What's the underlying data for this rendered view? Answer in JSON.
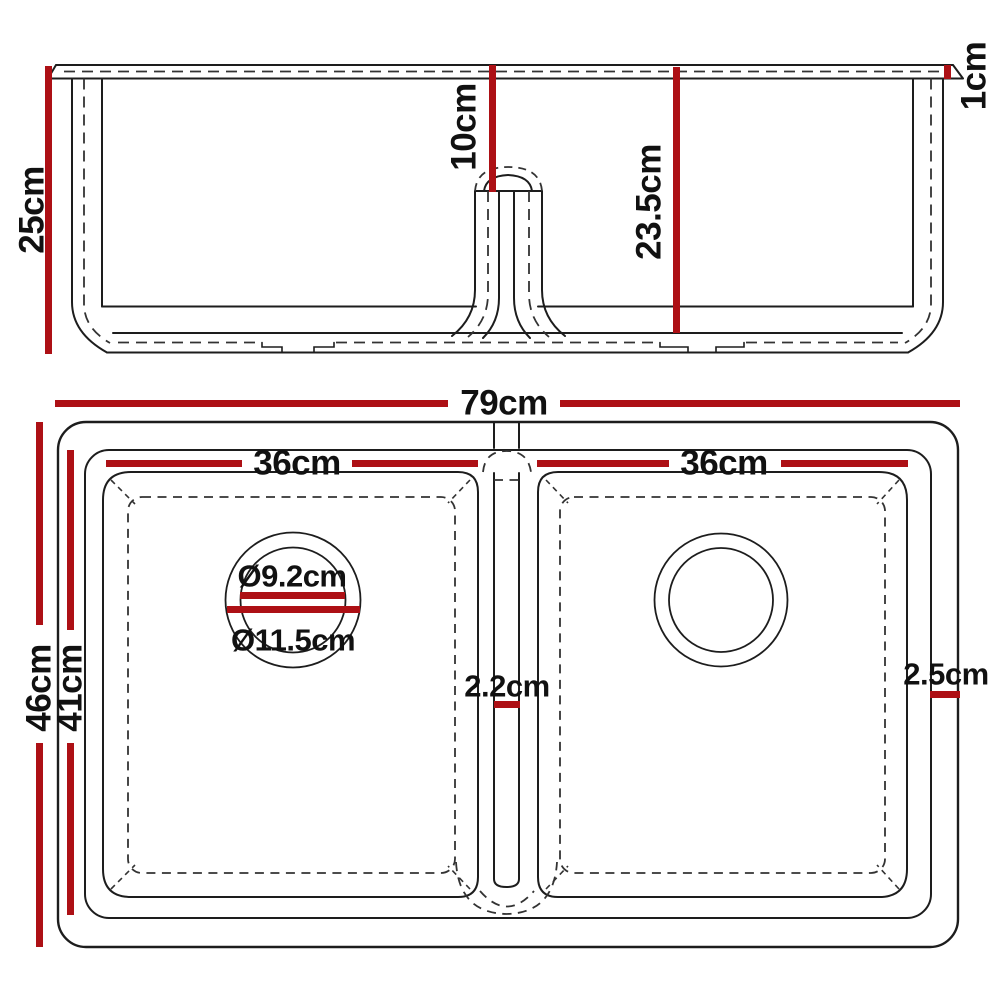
{
  "diagram": {
    "title": "Double bowl sink dimension diagram",
    "accent_color": "#ad1015",
    "line_color": "#1d1d1d",
    "dash_color": "#333333",
    "background": "#ffffff"
  },
  "elevation": {
    "name": "front-elevation-view",
    "dims": [
      {
        "id": "overall-height",
        "label": "25cm",
        "value": 25,
        "unit": "cm",
        "orientation": "vertical"
      },
      {
        "id": "divider-height-from-rim",
        "label": "10cm",
        "value": 10,
        "unit": "cm",
        "orientation": "vertical"
      },
      {
        "id": "bowl-inner-depth",
        "label": "23.5cm",
        "value": 23.5,
        "unit": "cm",
        "orientation": "vertical"
      },
      {
        "id": "rim-thickness",
        "label": "1cm",
        "value": 1,
        "unit": "cm",
        "orientation": "vertical"
      }
    ]
  },
  "plan": {
    "name": "top-plan-view",
    "dims": [
      {
        "id": "overall-width",
        "label": "79cm",
        "value": 79,
        "unit": "cm",
        "orientation": "horizontal"
      },
      {
        "id": "left-bowl-width",
        "label": "36cm",
        "value": 36,
        "unit": "cm",
        "orientation": "horizontal"
      },
      {
        "id": "right-bowl-width",
        "label": "36cm",
        "value": 36,
        "unit": "cm",
        "orientation": "horizontal"
      },
      {
        "id": "overall-depth",
        "label": "46cm",
        "value": 46,
        "unit": "cm",
        "orientation": "vertical"
      },
      {
        "id": "bowl-front-back-depth",
        "label": "41cm",
        "value": 41,
        "unit": "cm",
        "orientation": "vertical"
      },
      {
        "id": "drain-hole-diameter",
        "label": "Ø9.2cm",
        "value": 9.2,
        "unit": "cm",
        "orientation": "diameter"
      },
      {
        "id": "drain-recess-diameter",
        "label": "Ø11.5cm",
        "value": 11.5,
        "unit": "cm",
        "orientation": "diameter"
      },
      {
        "id": "divider-thickness",
        "label": "2.2cm",
        "value": 2.2,
        "unit": "cm",
        "orientation": "horizontal"
      },
      {
        "id": "rim-border-width",
        "label": "2.5cm",
        "value": 2.5,
        "unit": "cm",
        "orientation": "horizontal"
      }
    ]
  }
}
